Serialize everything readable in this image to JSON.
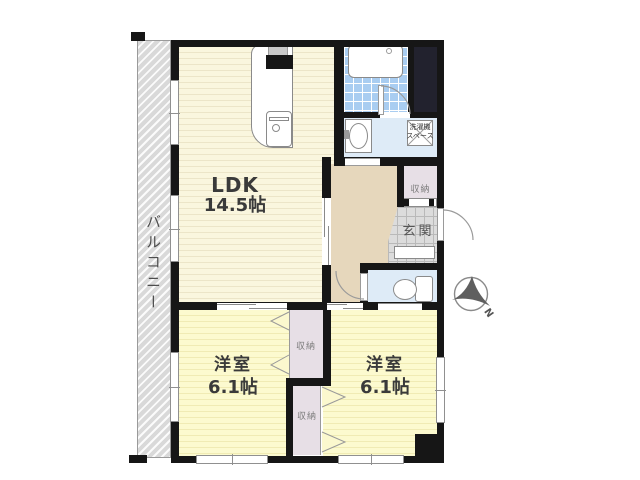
{
  "plan": {
    "title": "apartment-floor-plan",
    "rooms": {
      "ldk": {
        "label": "LDK",
        "size": "14.5帖"
      },
      "bedroom_left": {
        "label": "洋室",
        "size": "6.1帖"
      },
      "bedroom_right": {
        "label": "洋室",
        "size": "6.1帖"
      },
      "balcony": {
        "label": "バルコニー"
      },
      "entrance": {
        "label": "玄関"
      },
      "closet_hall": {
        "label": "収納"
      },
      "closet_top": {
        "label": "収納"
      },
      "closet_bottom": {
        "label": "収納"
      },
      "laundry": {
        "line1": "洗濯機",
        "line2": "スペース"
      }
    },
    "compass": {
      "label": "N"
    },
    "colors": {
      "wall": "#161616",
      "ldk_floor": "#FAF6DE",
      "bedroom_floor": "#FCFACF",
      "hall_floor": "#E6D7BC",
      "closet_floor": "#E7DFE6",
      "bath_tile": "#A9CDF1",
      "wet_area_floor": "#DEEBF7",
      "entrance_tile": "#DCDCDC",
      "balcony": "#D9D9D9",
      "dark_zone": "#22222E"
    }
  }
}
